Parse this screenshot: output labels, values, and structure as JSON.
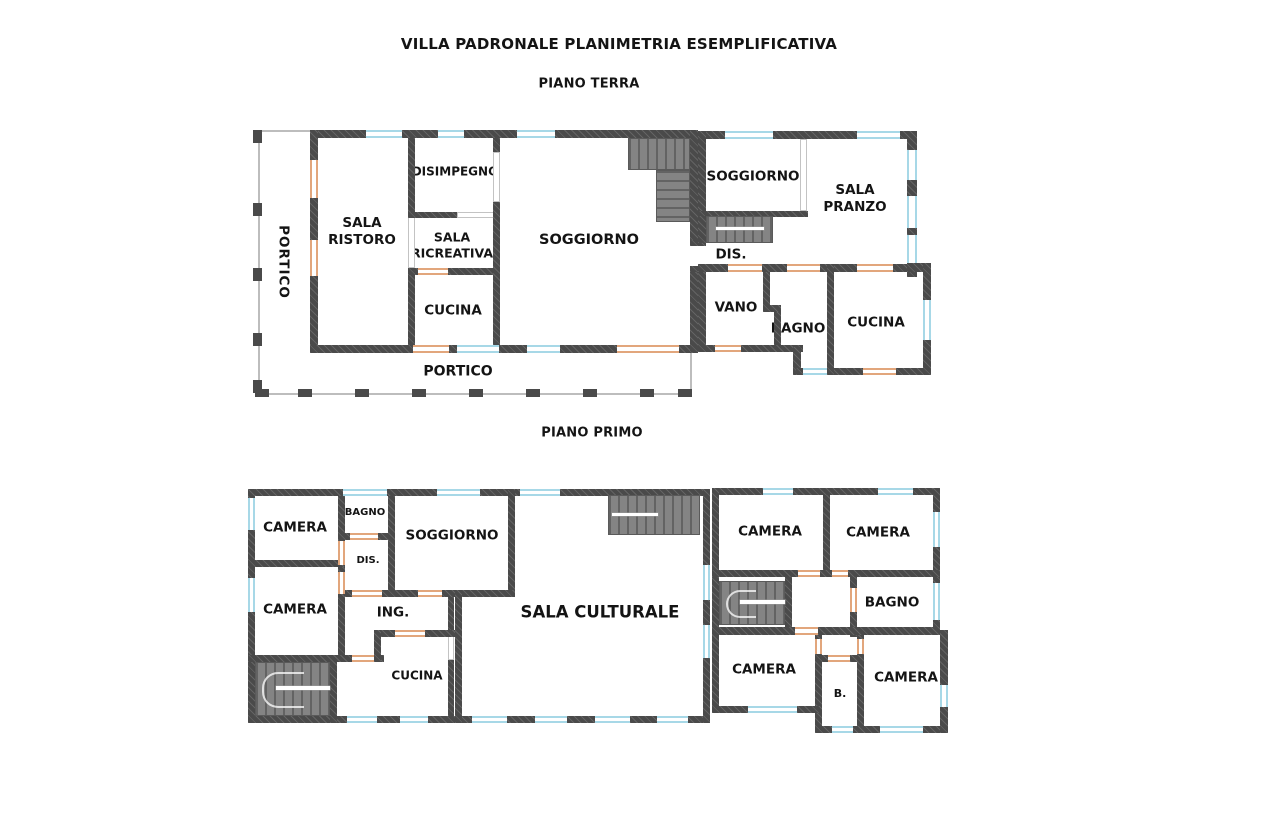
{
  "title": "VILLA PADRONALE PLANIMETRIA ESEMPLIFICATIVA",
  "ground_floor": {
    "label": "PIANO TERRA",
    "rooms": {
      "portico_left": "PORTICO",
      "sala_ristoro": "SALA RISTORO",
      "disimpegno": "DISIMPEGNO",
      "sala_ricreativa": "SALA RICREATIVA",
      "cucina": "CUCINA",
      "soggiorno": "SOGGIORNO",
      "portico_bottom": "PORTICO",
      "soggiorno_right": "SOGGIORNO",
      "sala_pranzo": "SALA PRANZO",
      "dis": "DIS.",
      "vano": "VANO",
      "bagno": "BAGNO",
      "cucina_right": "CUCINA"
    }
  },
  "first_floor": {
    "label": "PIANO PRIMO",
    "rooms": {
      "camera_nw": "CAMERA",
      "bagno_nw": "BAGNO",
      "soggiorno": "SOGGIORNO",
      "dis": "DIS.",
      "camera_w": "CAMERA",
      "ing": "ING.",
      "cucina": "CUCINA",
      "sala_culturale": "SALA CULTURALE",
      "camera_ne": "CAMERA",
      "camera_ne2": "CAMERA",
      "bagno_e": "BAGNO",
      "camera_sw": "CAMERA",
      "b": "B.",
      "camera_se": "CAMERA"
    }
  },
  "colors": {
    "wall": "#4a4a4a",
    "window": "#a7d8e7",
    "door": "#e2a67c",
    "stair": "#7b7b7b",
    "portico_line": "#bdbdbd"
  }
}
